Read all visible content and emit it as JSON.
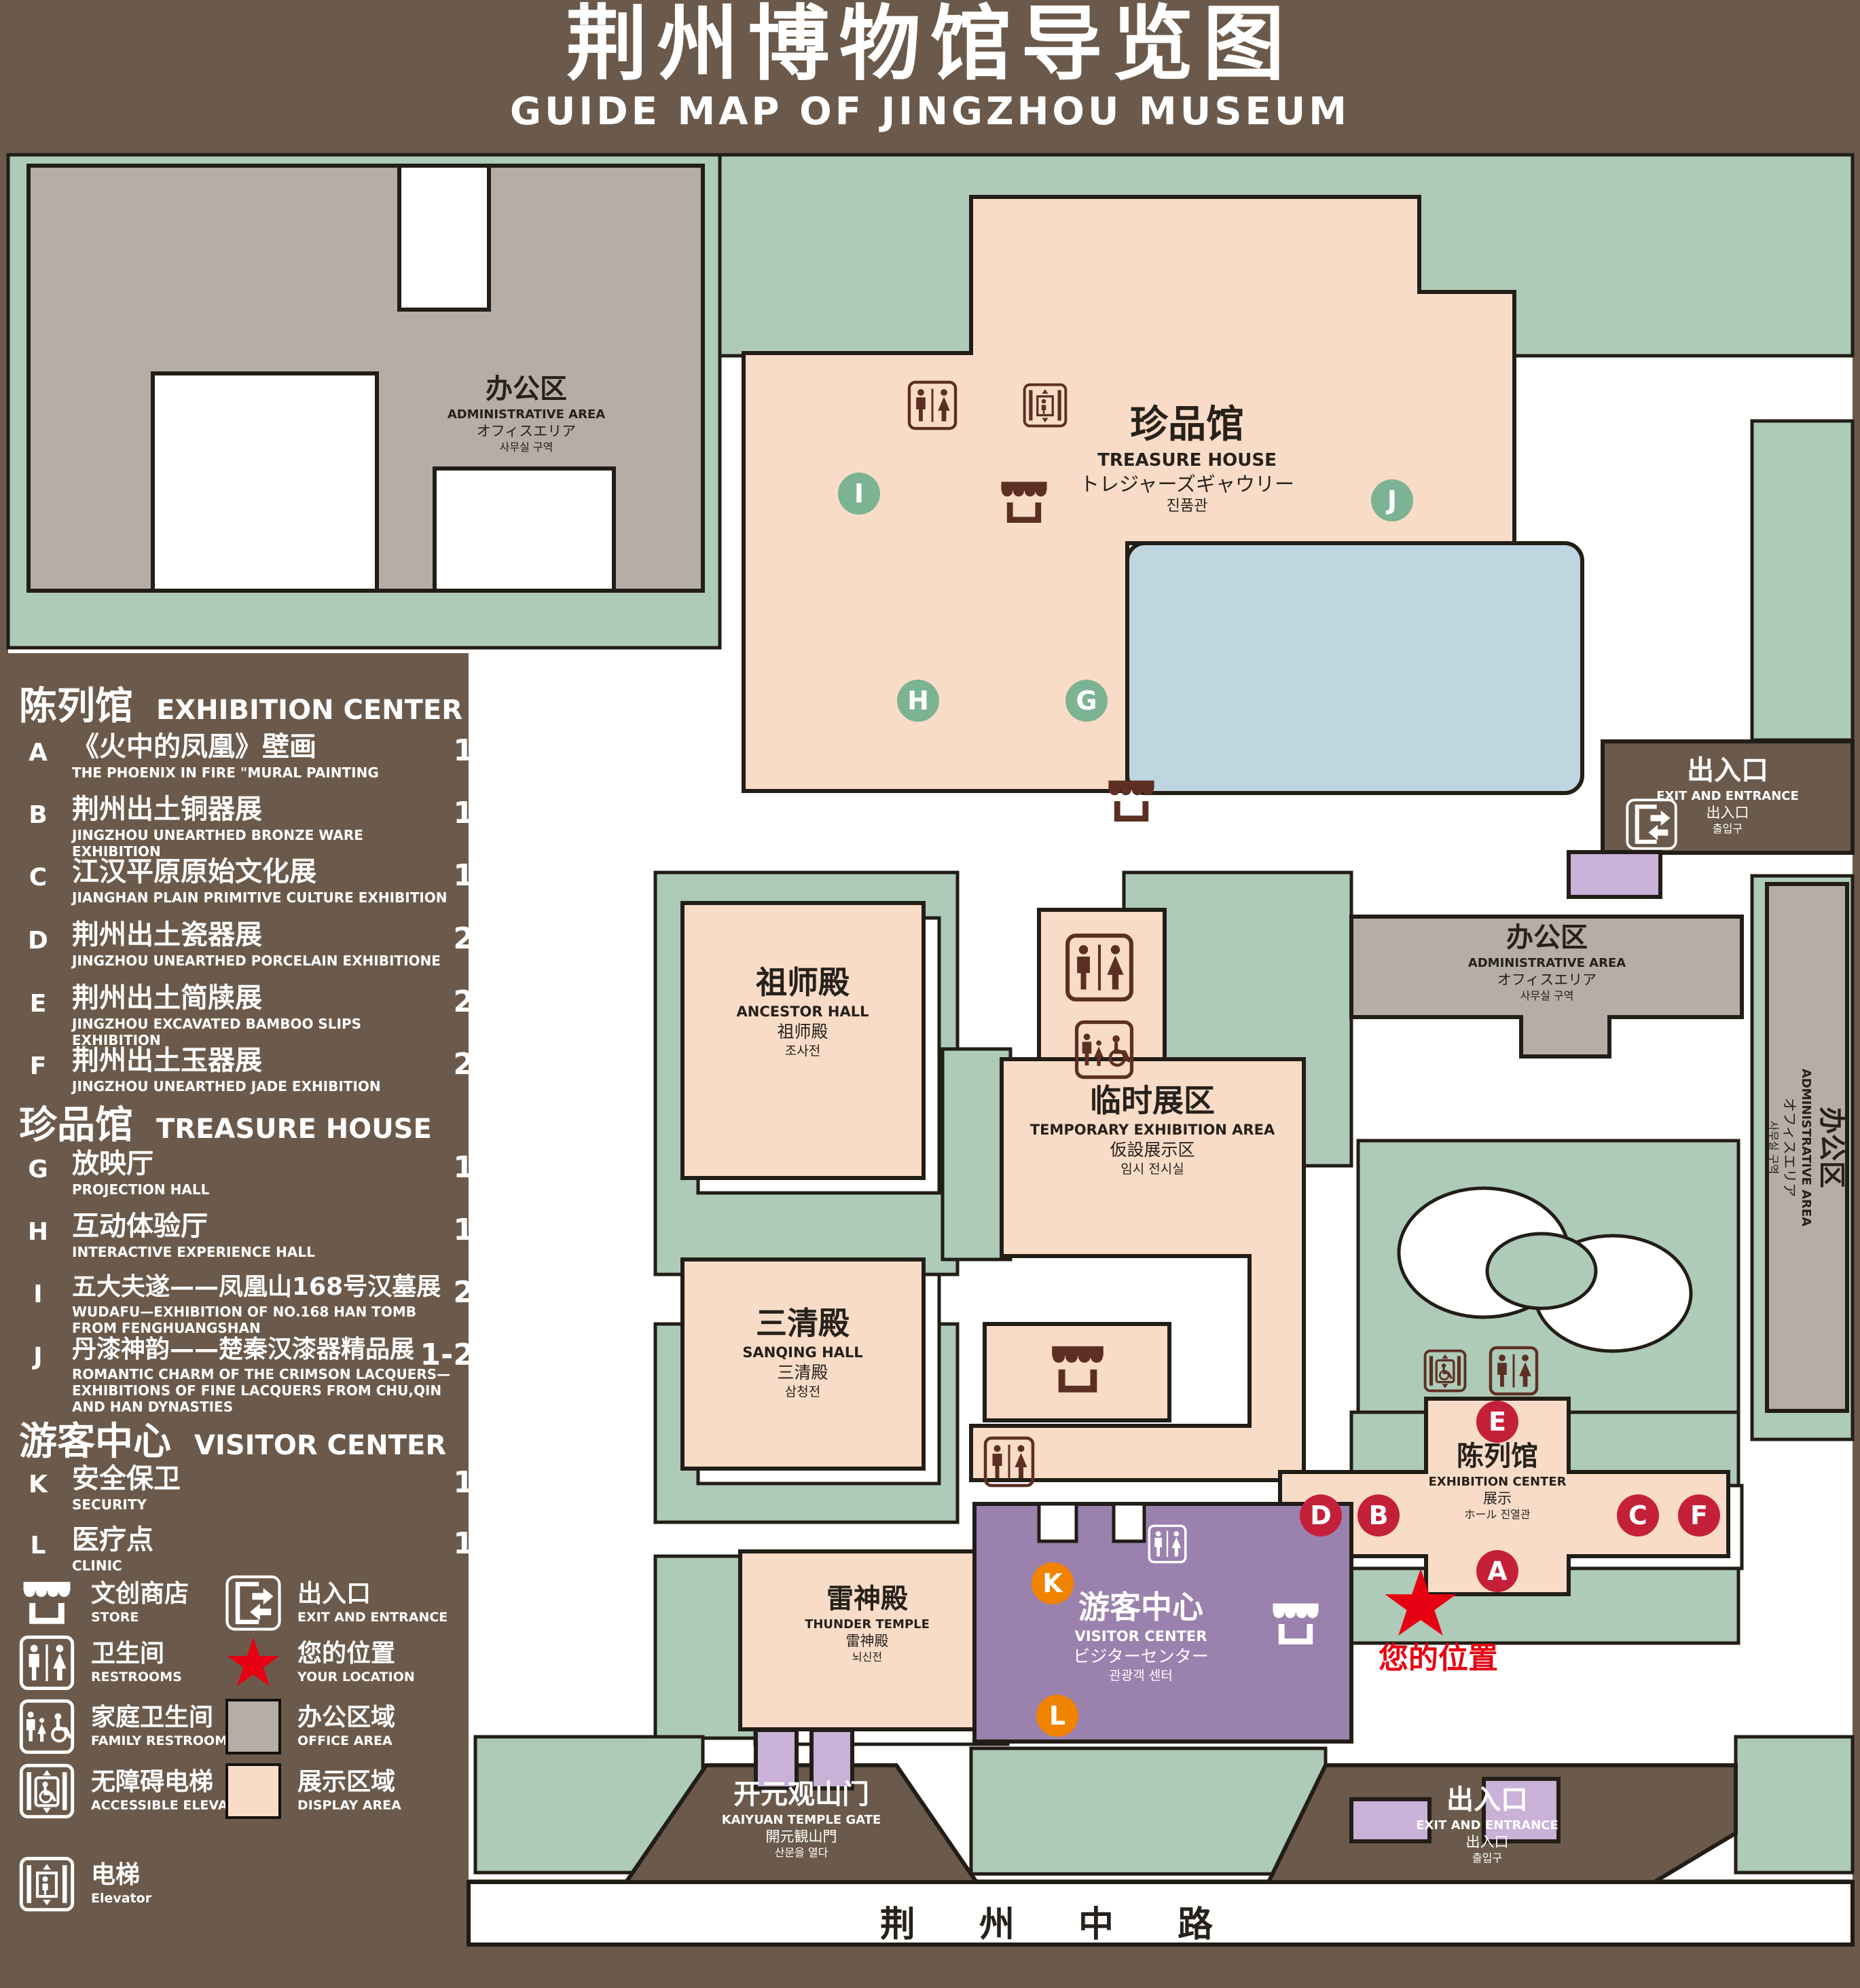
{
  "title": {
    "zh": "荆州博物馆导览图",
    "en": "GUIDE MAP OF JINGZHOU MUSEUM"
  },
  "legend": {
    "sections": [
      {
        "zh": "陈列馆",
        "en": "EXHIBITION CENTER",
        "items": [
          {
            "key": "A",
            "zh": "《火中的凤凰》壁画",
            "en": "THE PHOENIX IN FIRE \"MURAL PAINTING",
            "floor": "1F"
          },
          {
            "key": "B",
            "zh": "荆州出土铜器展",
            "en": "JINGZHOU UNEARTHED BRONZE WARE EXHIBITION",
            "floor": "1F"
          },
          {
            "key": "C",
            "zh": "江汉平原原始文化展",
            "en": "JIANGHAN PLAIN PRIMITIVE CULTURE EXHIBITION",
            "floor": "1F"
          },
          {
            "key": "D",
            "zh": "荆州出土瓷器展",
            "en": "JINGZHOU UNEARTHED PORCELAIN EXHIBITIONE",
            "floor": "2F"
          },
          {
            "key": "E",
            "zh": "荆州出土简牍展",
            "en": "JINGZHOU EXCAVATED BAMBOO SLIPS EXHIBITION",
            "floor": "2F"
          },
          {
            "key": "F",
            "zh": "荆州出土玉器展",
            "en": "JINGZHOU UNEARTHED JADE EXHIBITION",
            "floor": "2F"
          }
        ]
      },
      {
        "zh": "珍品馆",
        "en": "TREASURE HOUSE",
        "items": [
          {
            "key": "G",
            "zh": "放映厅",
            "en": "PROJECTION HALL",
            "floor": "1F"
          },
          {
            "key": "H",
            "zh": "互动体验厅",
            "en": "INTERACTIVE EXPERIENCE HALL",
            "floor": "1F"
          },
          {
            "key": "I",
            "zh": "五大夫遂——凤凰山168号汉墓展",
            "en": "WUDAFU—EXHIBITION OF NO.168 HAN TOMB FROM FENGHUANGSHAN",
            "floor": "2F"
          },
          {
            "key": "J",
            "zh": "丹漆神韵——楚秦汉漆器精品展",
            "en": "ROMANTIC CHARM OF THE CRIMSON LACQUERS—EXHIBITIONS OF FINE LACQUERS FROM CHU,QIN AND HAN DYNASTIES",
            "floor": "1-2F"
          }
        ]
      },
      {
        "zh": "游客中心",
        "en": "VISITOR CENTER",
        "items": [
          {
            "key": "K",
            "zh": "安全保卫",
            "en": "SECURITY",
            "floor": "1F"
          },
          {
            "key": "L",
            "zh": "医疗点",
            "en": "CLINIC",
            "floor": "1F"
          }
        ]
      }
    ],
    "symbols": [
      {
        "id": "store",
        "zh": "文创商店",
        "en": "STORE"
      },
      {
        "id": "exit",
        "zh": "出入口",
        "en": "EXIT AND ENTRANCE"
      },
      {
        "id": "restrooms",
        "zh": "卫生间",
        "en": "RESTROOMS"
      },
      {
        "id": "your-location",
        "zh": "您的位置",
        "en": "YOUR LOCATION"
      },
      {
        "id": "family-restrooms",
        "zh": "家庭卫生间",
        "en": "FAMILY RESTROOMS"
      },
      {
        "id": "office-area",
        "zh": "办公区域",
        "en": "OFFICE AREA"
      },
      {
        "id": "accessible-elevator",
        "zh": "无障碍电梯",
        "en": "ACCESSIBLE ELEVATOR"
      },
      {
        "id": "display-area",
        "zh": "展示区域",
        "en": "DISPLAY AREA"
      },
      {
        "id": "elevator",
        "zh": "电梯",
        "en": "Elevator"
      }
    ]
  },
  "map": {
    "buildings": {
      "admin": {
        "zh": "办公区",
        "en": "ADMINISTRATIVE AREA",
        "jp": "オフィスエリア",
        "kr": "사무실 구역"
      },
      "treasure_house": {
        "zh": "珍品馆",
        "en": "TREASURE HOUSE",
        "jp": "トレジャーズギャウリー",
        "kr": "진품관"
      },
      "ancestor_hall": {
        "zh": "祖师殿",
        "en": "ANCESTOR HALL",
        "jp": "祖师殿",
        "kr": "조사전"
      },
      "temporary_exhibition": {
        "zh": "临时展区",
        "en": "TEMPORARY EXHIBITION AREA",
        "jp": "仮設展示区",
        "kr": "임시 전시실"
      },
      "sanqing_hall": {
        "zh": "三清殿",
        "en": "SANQING HALL",
        "jp": "三清殿",
        "kr": "삼청전"
      },
      "thunder_temple": {
        "zh": "雷神殿",
        "en": "THUNDER TEMPLE",
        "jp": "雷神殿",
        "kr": "뇌신전"
      },
      "visitor_center": {
        "zh": "游客中心",
        "en": "VISITOR CENTER",
        "jp": "ビジターセンター",
        "kr": "관광객 센터"
      },
      "exhibition_center": {
        "zh": "陈列馆",
        "en": "EXHIBITION CENTER",
        "jp": "展示",
        "kr": "ホール 진열관"
      },
      "kaiyuan_gate": {
        "zh": "开元观山门",
        "en": "KAIYUAN TEMPLE GATE",
        "jp": "開元観山門",
        "kr": "산문을 열다"
      },
      "exit": {
        "zh": "出入口",
        "en": "EXIT AND ENTRANCE",
        "jp": "出入口",
        "kr": "출입구"
      }
    },
    "markers": {
      "A": "A",
      "B": "B",
      "C": "C",
      "D": "D",
      "E": "E",
      "F": "F",
      "G": "G",
      "H": "H",
      "I": "I",
      "J": "J",
      "K": "K",
      "L": "L"
    },
    "your_location": "您的位置",
    "road": "荆 州 中 路"
  },
  "colors": {
    "background_brown": "#6b5a4b",
    "lawn_green": "#aecab8",
    "display_pink": "#f9dcc8",
    "office_gray": "#b6ada7",
    "visitor_purple": "#9b81ad",
    "gate_purple": "#c9b1d8",
    "pond_blue": "#bfd6e0",
    "marker_red": "#c5203a",
    "marker_green": "#7cb392",
    "marker_orange": "#f08300",
    "icon_maroon": "#5d2f23",
    "star_red": "#e60012"
  }
}
